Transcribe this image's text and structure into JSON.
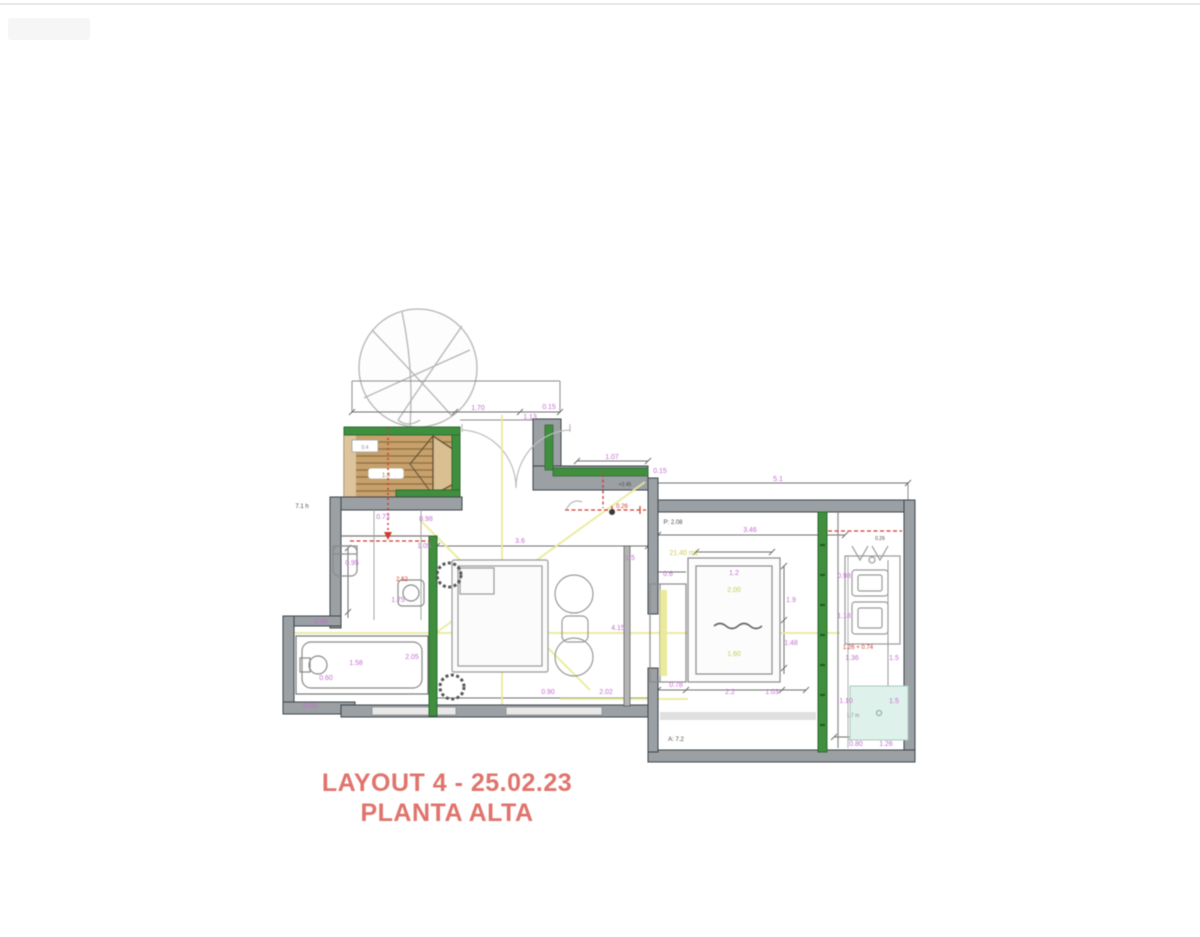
{
  "title_block": {
    "line1": "LAYOUT 4 - 25.02.23",
    "line2": "PLANTA ALTA"
  },
  "colors": {
    "wall_gray": "#9ba0a4",
    "green_wall": "#3f8f3f",
    "deck_tan": "#c7a06b",
    "title_red": "#e0736c",
    "yellow_line": "#e9ea9a",
    "teal_shower": "#def1ea",
    "dimension_magenta": "#c36fd0",
    "red_dashed": "#d23a2e"
  },
  "plan": {
    "palette": {
      "m": "#c36fd0",
      "r": "#d23a2e",
      "y": "#c9cc4e",
      "k": "#4a4a4a",
      "g": "#8a8a8a",
      "t": "#9c7f4e"
    },
    "annotations": [
      {
        "t": "1.70",
        "x": 478,
        "y": 410,
        "c": "m"
      },
      {
        "t": "1.13",
        "x": 530,
        "y": 419,
        "c": "m"
      },
      {
        "t": "0.15",
        "x": 549,
        "y": 409,
        "c": "m"
      },
      {
        "t": "1.07",
        "x": 612,
        "y": 459,
        "c": "m"
      },
      {
        "t": "5.1",
        "x": 778,
        "y": 481,
        "c": "m"
      },
      {
        "t": "0.15",
        "x": 660,
        "y": 473,
        "c": "m"
      },
      {
        "t": "3.46",
        "x": 750,
        "y": 532,
        "c": "m"
      },
      {
        "t": "P: 2.08",
        "x": 673,
        "y": 524,
        "c": "k",
        "s": 6
      },
      {
        "t": "+2.45",
        "x": 625,
        "y": 486,
        "c": "k",
        "s": 5
      },
      {
        "t": "1.8",
        "x": 386,
        "y": 477,
        "c": "t",
        "s": 6
      },
      {
        "t": "0.4",
        "x": 365,
        "y": 449,
        "c": "g",
        "s": 5
      },
      {
        "t": "0.73",
        "x": 383,
        "y": 519,
        "c": "m"
      },
      {
        "t": "0.98",
        "x": 426,
        "y": 521,
        "c": "m"
      },
      {
        "t": "1.05",
        "x": 424,
        "y": 548,
        "c": "m"
      },
      {
        "t": "2.62",
        "x": 402,
        "y": 581,
        "c": "r",
        "s": 6
      },
      {
        "t": "1.75",
        "x": 398,
        "y": 602,
        "c": "m"
      },
      {
        "t": "0.95",
        "x": 352,
        "y": 565,
        "c": "m"
      },
      {
        "t": "0.98",
        "x": 321,
        "y": 624,
        "c": "m"
      },
      {
        "t": "1.58",
        "x": 356,
        "y": 665,
        "c": "m"
      },
      {
        "t": "0.60",
        "x": 326,
        "y": 680,
        "c": "m"
      },
      {
        "t": "0.60",
        "x": 310,
        "y": 708,
        "c": "m"
      },
      {
        "t": "2.05",
        "x": 412,
        "y": 659,
        "c": "m"
      },
      {
        "t": "3.6",
        "x": 520,
        "y": 543,
        "c": "m"
      },
      {
        "t": "0.90",
        "x": 548,
        "y": 694,
        "c": "m"
      },
      {
        "t": "1.5",
        "x": 630,
        "y": 560,
        "c": "m"
      },
      {
        "t": "2.02",
        "x": 606,
        "y": 694,
        "c": "m"
      },
      {
        "t": "4.15",
        "x": 618,
        "y": 630,
        "c": "m"
      },
      {
        "t": "0.26",
        "x": 622,
        "y": 508,
        "c": "r",
        "s": 6
      },
      {
        "t": "1.2",
        "x": 734,
        "y": 575,
        "c": "m"
      },
      {
        "t": "0.6",
        "x": 668,
        "y": 576,
        "c": "m"
      },
      {
        "t": "1.9",
        "x": 791,
        "y": 602,
        "c": "m"
      },
      {
        "t": "1.48",
        "x": 791,
        "y": 645,
        "c": "m"
      },
      {
        "t": "0.78",
        "x": 676,
        "y": 687,
        "c": "m"
      },
      {
        "t": "2.2",
        "x": 730,
        "y": 694,
        "c": "m"
      },
      {
        "t": "1.03",
        "x": 772,
        "y": 694,
        "c": "m"
      },
      {
        "t": "2.00",
        "x": 734,
        "y": 592,
        "c": "y"
      },
      {
        "t": "1.60",
        "x": 734,
        "y": 656,
        "c": "y"
      },
      {
        "t": "21.40 m2",
        "x": 684,
        "y": 555,
        "c": "y"
      },
      {
        "t": "0.98",
        "x": 844,
        "y": 578,
        "c": "m"
      },
      {
        "t": "1.18",
        "x": 844,
        "y": 618,
        "c": "m"
      },
      {
        "t": "1.36",
        "x": 852,
        "y": 660,
        "c": "m"
      },
      {
        "t": "1.5",
        "x": 894,
        "y": 660,
        "c": "m"
      },
      {
        "t": "1.10",
        "x": 846,
        "y": 703,
        "c": "m"
      },
      {
        "t": "1.5",
        "x": 894,
        "y": 703,
        "c": "m"
      },
      {
        "t": "0.80",
        "x": 856,
        "y": 746,
        "c": "m"
      },
      {
        "t": "1.26",
        "x": 886,
        "y": 746,
        "c": "m"
      },
      {
        "t": "1.26 + 0.74",
        "x": 858,
        "y": 649,
        "c": "r",
        "s": 6
      },
      {
        "t": "0.26",
        "x": 880,
        "y": 540,
        "c": "k",
        "s": 5
      },
      {
        "t": "A: 7.2",
        "x": 676,
        "y": 741,
        "c": "k",
        "s": 6
      },
      {
        "t": "7.1 h",
        "x": 302,
        "y": 508,
        "c": "k",
        "s": 6
      },
      {
        "t": "1.7 m",
        "x": 853,
        "y": 717,
        "c": "g",
        "s": 5
      }
    ]
  }
}
